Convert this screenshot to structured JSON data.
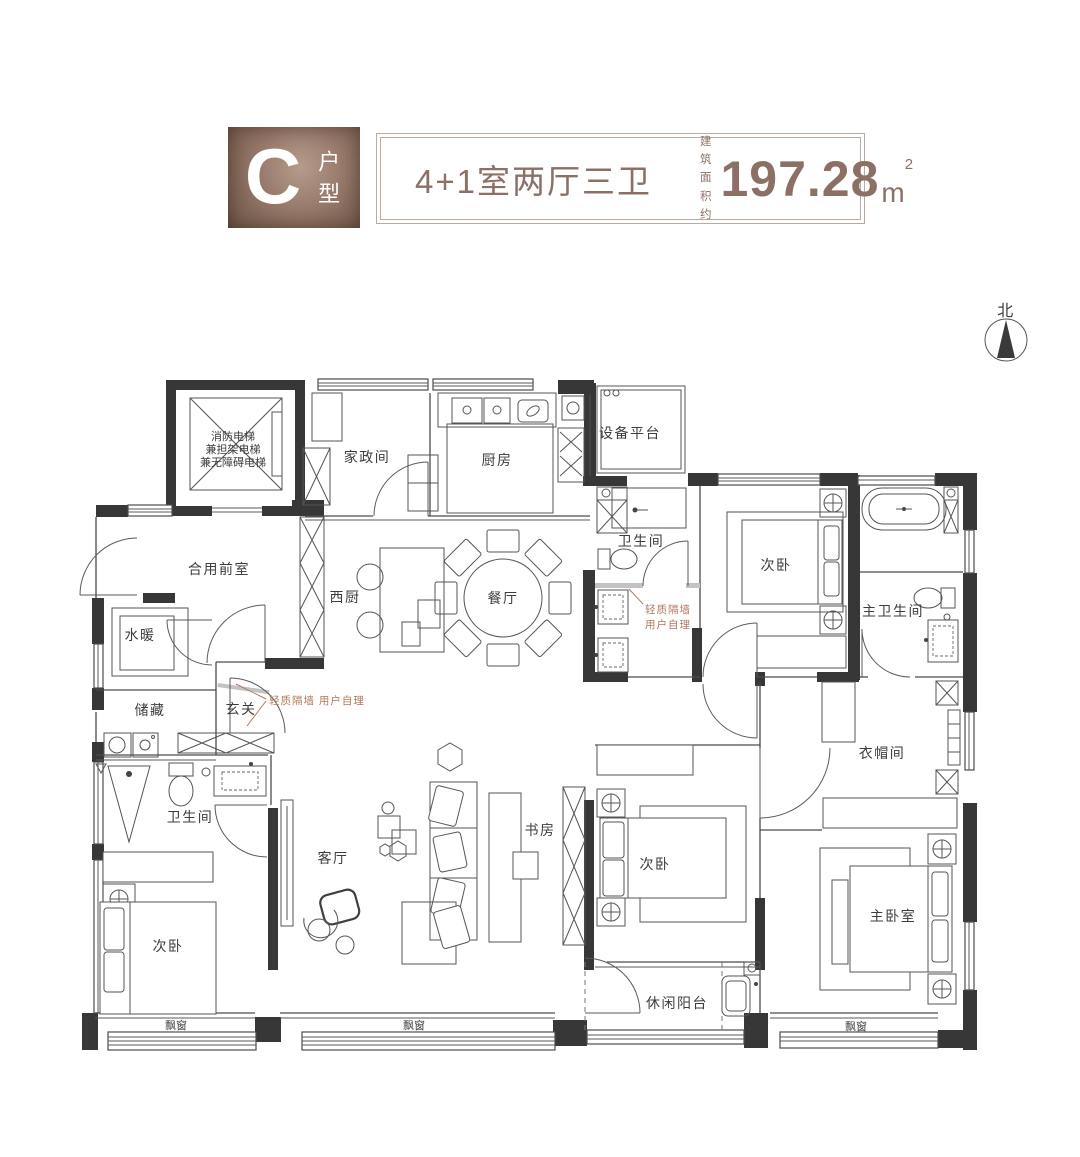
{
  "header": {
    "type_letter": "C",
    "type_label": "户型",
    "layout_title": "4+1室两厅三卫",
    "area_prefix_line1": "建 筑",
    "area_prefix_line2": "面积约",
    "area_value": "197.28",
    "area_unit": "m",
    "area_unit_sup": "2"
  },
  "compass": {
    "label": "北"
  },
  "annotations": {
    "partition_note": "轻质隔墙 用户自理",
    "partition_note_line1": "轻质隔墙",
    "partition_note_line2": "用户自理"
  },
  "rooms": {
    "elevator_line1": "消防电梯",
    "elevator_line2": "兼担架电梯",
    "elevator_line3": "兼无障碍电梯",
    "housekeeping": "家政间",
    "kitchen": "厨房",
    "equipment_platform": "设备平台",
    "shared_front_room": "合用前室",
    "west_kitchen": "西厨",
    "dining": "餐厅",
    "bath_top": "卫生间",
    "bedroom_top_right": "次卧",
    "master_bath": "主卫生间",
    "plumbing": "水暖",
    "storage": "储藏",
    "foyer": "玄关",
    "bath_left": "卫生间",
    "living": "客厅",
    "study": "书房",
    "bedroom_bottom_left": "次卧",
    "bedroom_bottom_mid": "次卧",
    "master_bedroom": "主卧室",
    "cloakroom": "衣帽间",
    "balcony": "休闲阳台",
    "bay_window_left": "飘窗",
    "bay_window_mid": "飘窗",
    "bay_window_right": "飘窗"
  },
  "colors": {
    "wall": "#373737",
    "line": "#4c4c4c",
    "annotation": "#b2795e",
    "header_text": "#8c7065",
    "header_border": "#b9aba2",
    "bronze_dark": "#6b5446",
    "bronze_light": "#b59c8c"
  }
}
